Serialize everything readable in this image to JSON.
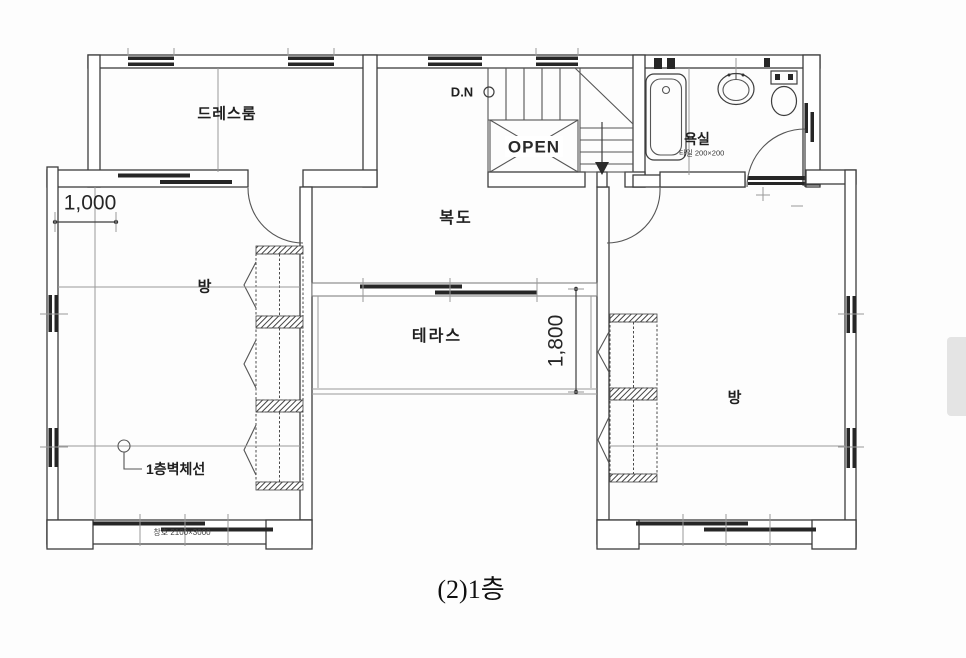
{
  "meta": {
    "caption": "(2)1층"
  },
  "rooms": {
    "dressroom": {
      "label": "드레스룸"
    },
    "corridor": {
      "label": "복도"
    },
    "terrace": {
      "label": "테라스"
    },
    "room_left": {
      "label": "방"
    },
    "room_right": {
      "label": "방"
    },
    "bathroom": {
      "label": "욕실",
      "finish_note": "타일 200×200"
    }
  },
  "stairs": {
    "direction_label": "D.N",
    "void_label": "OPEN"
  },
  "dimensions": {
    "top_left": "1,000",
    "terrace_depth": "1,800"
  },
  "annotations": {
    "wall_line_label": "1층벽체선",
    "window_spec": "창호 2100×3000"
  },
  "colors": {
    "ink": "#3d3d3d",
    "background": "#fdfdfd",
    "scrollbar_thumb": "#e4e4e4"
  }
}
